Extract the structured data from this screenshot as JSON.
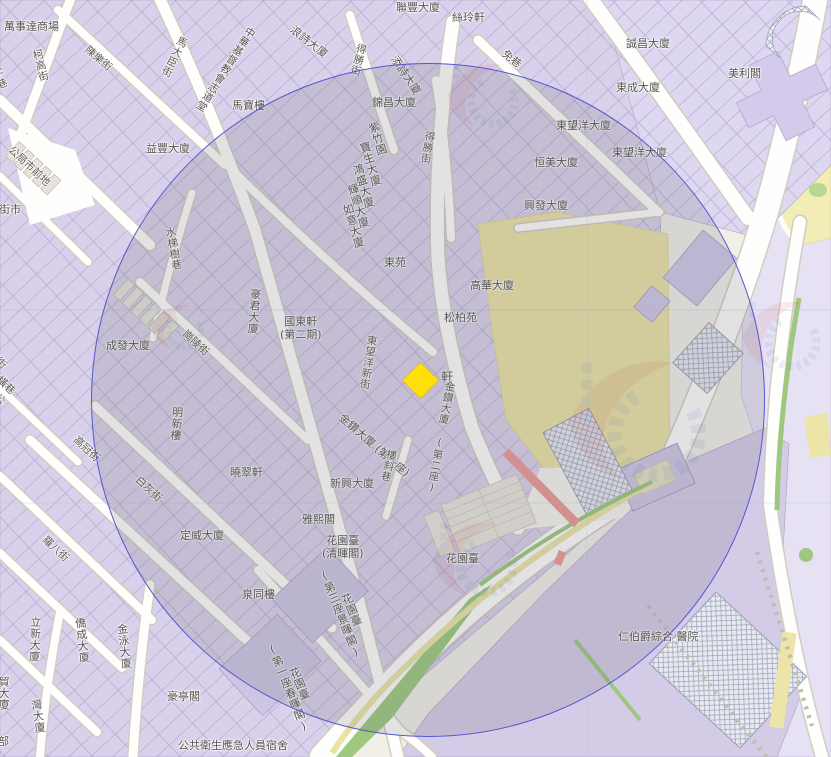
{
  "map": {
    "kind": "street-map-with-radius-overlay",
    "colors": {
      "land": "#f2efe9",
      "building_block": "#d9d1eb",
      "building_block_light": "#ded7f1",
      "hospital_grounds": "#d4cce7",
      "campus_yellow": "#ebe3a6",
      "park_yellow": "#f2edb6",
      "grass_green": "#9dc87e",
      "road_fill": "#fefefc",
      "red_road": "#eb9a96",
      "circle_stroke": "#5656d0",
      "circle_fill": "rgba(104,104,116,0.19)",
      "marker_yellow": "#ffdf07",
      "label_text": "#55514f"
    },
    "selection_circle": {
      "cx": 428,
      "cy": 400,
      "r": 337
    },
    "marker": {
      "shape": "diamond",
      "color": "#ffdf07",
      "label": "軒",
      "x": 408,
      "y": 368
    },
    "labels": [
      {
        "t": "萬事達商場",
        "x": 4,
        "y": 21,
        "k": "b"
      },
      {
        "t": "聯豐大廈",
        "x": 396,
        "y": 2,
        "k": "b"
      },
      {
        "t": "絲玲軒",
        "x": 452,
        "y": 12,
        "k": "b"
      },
      {
        "t": "誠昌大廈",
        "x": 626,
        "y": 38,
        "k": "b"
      },
      {
        "t": "美利閣",
        "x": 728,
        "y": 68,
        "k": "b"
      },
      {
        "t": "東成大廈",
        "x": 616,
        "y": 82,
        "k": "b"
      },
      {
        "t": "東望洋大廈",
        "x": 556,
        "y": 120,
        "k": "b"
      },
      {
        "t": "東望洋大廈",
        "x": 612,
        "y": 147,
        "k": "b"
      },
      {
        "t": "恒美大廈",
        "x": 534,
        "y": 157,
        "k": "b"
      },
      {
        "t": "馬寶樓",
        "x": 232,
        "y": 100,
        "k": "b"
      },
      {
        "t": "益豐大廈",
        "x": 146,
        "y": 143,
        "k": "b"
      },
      {
        "t": "錦昌大廈",
        "x": 372,
        "y": 97,
        "k": "b"
      },
      {
        "t": "興發大廈",
        "x": 524,
        "y": 200,
        "k": "b"
      },
      {
        "t": "東苑",
        "x": 384,
        "y": 257,
        "k": "b"
      },
      {
        "t": "高華大廈",
        "x": 470,
        "y": 280,
        "k": "b"
      },
      {
        "t": "松柏苑",
        "x": 444,
        "y": 312,
        "k": "b"
      },
      {
        "t": "國東軒\n(第二期)",
        "x": 280,
        "y": 316,
        "k": "b"
      },
      {
        "t": "成發大廈",
        "x": 106,
        "y": 340,
        "k": "b"
      },
      {
        "t": "曉翠軒",
        "x": 230,
        "y": 467,
        "k": "b"
      },
      {
        "t": "定威大廈",
        "x": 180,
        "y": 530,
        "k": "b"
      },
      {
        "t": "新興大廈",
        "x": 330,
        "y": 478,
        "k": "b"
      },
      {
        "t": "雅熙閣",
        "x": 302,
        "y": 514,
        "k": "b"
      },
      {
        "t": "花園臺\n(清暉閣)",
        "x": 322,
        "y": 535,
        "k": "b"
      },
      {
        "t": "花園臺",
        "x": 446,
        "y": 553,
        "k": "b"
      },
      {
        "t": "泉同樓",
        "x": 242,
        "y": 589,
        "k": "b"
      },
      {
        "t": "豪亭閣",
        "x": 167,
        "y": 691,
        "k": "b"
      },
      {
        "t": "公共衛生應急人員宿舍",
        "x": 178,
        "y": 740,
        "k": "b"
      },
      {
        "t": "仁伯爵綜合 醫院",
        "x": 618,
        "y": 631,
        "k": "b"
      },
      {
        "t": "軒",
        "x": 441,
        "y": 371,
        "k": "b",
        "s": 12
      },
      {
        "t": "雀仔園街市",
        "x": -34,
        "y": 204,
        "k": "b"
      },
      {
        "t": "浪詩大廈",
        "x": 295,
        "y": 24,
        "r": 38,
        "k": "b"
      },
      {
        "t": "添詩大廈",
        "x": 398,
        "y": 54,
        "r": 56,
        "k": "b"
      },
      {
        "t": "金鑽大廈 (第一座)",
        "x": 344,
        "y": 412,
        "r": 41,
        "k": "b"
      },
      {
        "t": "中華基督教會志道堂",
        "x": 247,
        "y": 24,
        "r": 33,
        "v": 1,
        "k": "b",
        "s": 10.5
      },
      {
        "t": "紫竹園",
        "x": 366,
        "y": 124,
        "r": -17,
        "v": 1,
        "k": "b"
      },
      {
        "t": "寶生大廈",
        "x": 357,
        "y": 144,
        "r": -17,
        "v": 1,
        "k": "b"
      },
      {
        "t": "鴻盛大廈",
        "x": 350,
        "y": 166,
        "r": -17,
        "v": 1,
        "k": "b"
      },
      {
        "t": "輝順大廈",
        "x": 345,
        "y": 186,
        "r": -17,
        "v": 1,
        "k": "b"
      },
      {
        "t": "如意大廈",
        "x": 340,
        "y": 206,
        "r": -17,
        "v": 1,
        "k": "b"
      },
      {
        "t": "豪君大廈",
        "x": 249,
        "y": 288,
        "r": 4,
        "v": 1,
        "k": "b"
      },
      {
        "t": "明新樓",
        "x": 171,
        "y": 406,
        "r": 4,
        "v": 1,
        "k": "b"
      },
      {
        "t": "金鑽大廈 (第二座)",
        "x": 444,
        "y": 380,
        "r": 10,
        "v": 1,
        "k": "b",
        "s": 10.5
      },
      {
        "t": "花園臺\n(第三座景暉閣)",
        "x": 316,
        "y": 572,
        "r": -22,
        "v": 1,
        "k": "b"
      },
      {
        "t": "花園臺\n(第一座春暉閣)",
        "x": 264,
        "y": 646,
        "r": -22,
        "v": 1,
        "k": "b"
      },
      {
        "t": "立新大廈",
        "x": 29,
        "y": 616,
        "r": 2,
        "v": 1,
        "k": "b"
      },
      {
        "t": "僑成大廈",
        "x": 73,
        "y": 618,
        "r": -6,
        "v": 1,
        "k": "b"
      },
      {
        "t": "金泳大廈",
        "x": 115,
        "y": 624,
        "r": -6,
        "v": 1,
        "k": "b"
      },
      {
        "t": "貿大廈",
        "x": -3,
        "y": 676,
        "v": 1,
        "k": "b"
      },
      {
        "t": "灣大廈",
        "x": 29,
        "y": 700,
        "r": -8,
        "v": 1,
        "k": "b"
      },
      {
        "t": "部",
        "x": -2,
        "y": 736,
        "k": "b"
      },
      {
        "t": "柯高街",
        "x": 30,
        "y": 51,
        "r": -14,
        "v": 1,
        "k": "s"
      },
      {
        "t": "陳樂街",
        "x": 90,
        "y": 44,
        "r": 40,
        "k": "s"
      },
      {
        "t": "馬大臣街",
        "x": 178,
        "y": 34,
        "r": 26,
        "v": 1,
        "k": "s"
      },
      {
        "t": "得勝街",
        "x": 356,
        "y": 42,
        "r": 14,
        "v": 1,
        "k": "s"
      },
      {
        "t": "得勝街",
        "x": 424,
        "y": 130,
        "r": 10,
        "v": 1,
        "k": "s"
      },
      {
        "t": "免巷",
        "x": 507,
        "y": 48,
        "r": 38,
        "k": "s"
      },
      {
        "t": "東望洋新街",
        "x": 366,
        "y": 334,
        "r": 9,
        "v": 1,
        "k": "s"
      },
      {
        "t": "水梯樹巷",
        "x": 163,
        "y": 228,
        "r": -10,
        "v": 1,
        "k": "s"
      },
      {
        "t": "崗陵街",
        "x": 188,
        "y": 328,
        "r": 43,
        "k": "s"
      },
      {
        "t": "白灰街",
        "x": 141,
        "y": 474,
        "r": 43,
        "k": "s"
      },
      {
        "t": "高冠街",
        "x": 79,
        "y": 434,
        "r": 43,
        "k": "s"
      },
      {
        "t": "羅八街",
        "x": 48,
        "y": 534,
        "r": 43,
        "k": "s"
      },
      {
        "t": "公局市前地",
        "x": 14,
        "y": 144,
        "r": 43,
        "k": "s"
      },
      {
        "t": "公局市橫街",
        "x": -2,
        "y": 390,
        "r": 40,
        "v": 1,
        "k": "s",
        "s": 10
      },
      {
        "t": "羅憲新街",
        "x": -22,
        "y": 334,
        "r": 43,
        "k": "s"
      },
      {
        "t": "橫巷",
        "x": 2,
        "y": 374,
        "r": 43,
        "k": "s"
      },
      {
        "t": "十字巷",
        "x": -14,
        "y": 60,
        "r": -20,
        "v": 1,
        "k": "s"
      },
      {
        "t": "樓斜巷",
        "x": 386,
        "y": 448,
        "r": 14,
        "v": 1,
        "k": "s"
      }
    ]
  }
}
